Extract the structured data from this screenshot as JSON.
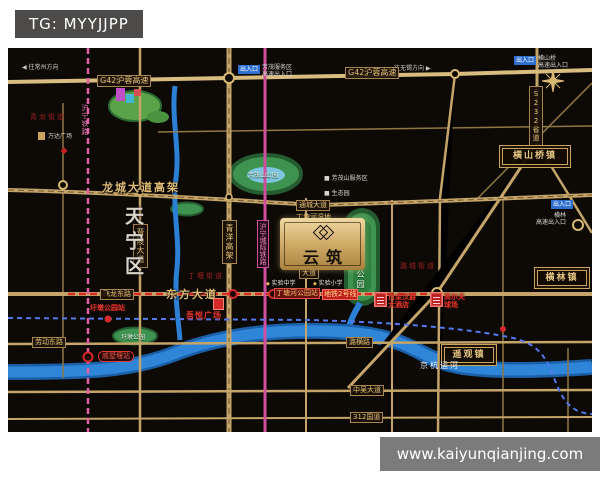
{
  "banners": {
    "top": "TG: MYYJJPP",
    "bottom": "www.kaiyunqianjing.com"
  },
  "project": {
    "name": "云筑"
  },
  "region": {
    "district": "天宁区",
    "sub1": "青龙街道",
    "sub2": "丁堰街道",
    "sub3": "潞城街道"
  },
  "towns": {
    "hengshanqiao": "横山桥镇",
    "henglin": "横林镇",
    "yaoguan": "遥观镇"
  },
  "roads": {
    "g42": "G42沪蓉高速",
    "longcheng": "龙城大道高架",
    "tongcheng": "通城大道",
    "dongfang": "东方大道",
    "feilong": "飞龙东路",
    "laodong": "劳动东路",
    "luheng": "潞横路",
    "zhongwu": "中吴大道",
    "g312": "312国道",
    "jinling": "晋陵大道",
    "qingyang": "青洋高架",
    "s232": "S232省道",
    "minor": "大道"
  },
  "transit": {
    "hux": "沪宁城际铁路",
    "huning": "沪宁铁路",
    "metro2": "地铁2号线",
    "st_dingtang": "丁塘河公园站",
    "st_qishuyan": "戚墅堰站",
    "st_yudun": "圩墩公园站",
    "canal": "京杭运河"
  },
  "parks": {
    "fangmao": "芳茂山公园",
    "wetland": "丁塘河湿地公园",
    "wetland_s": "丁塘河湿地",
    "yudun": "圩墩公园"
  },
  "pois": {
    "wuyue": "吾悦广场",
    "wanda": "万达广场",
    "service": "芳茂山服务区",
    "farm": "生态园",
    "hotel1": "白金汉爵",
    "hotel2": "大酒店",
    "golf1": "高尔夫",
    "golf2": "球场",
    "school1": "实验中学",
    "school2": "实验小学"
  },
  "entrances": {
    "chip": "出入口",
    "a1": "芳茂服务区",
    "a2": "高速出入口",
    "b1": "横林",
    "b2": "高速出入口",
    "c1": "横山桥",
    "c2": "高速出入口"
  },
  "directions": {
    "west": "往常州方向",
    "east": "往无锡方向"
  },
  "colors": {
    "road": "#c4a468",
    "highway": "#d8bc80",
    "metro2": "#d42a2a",
    "rail_pink": "#e060a8",
    "rail_magenta": "#cf4f9f",
    "river": "#2b7fd4",
    "park": "#3f9350",
    "accent_red": "#e23a2e",
    "blue_chip": "#2e6fd0",
    "banner_top": "#4d4b49",
    "banner_bottom": "#7b7b7b"
  }
}
